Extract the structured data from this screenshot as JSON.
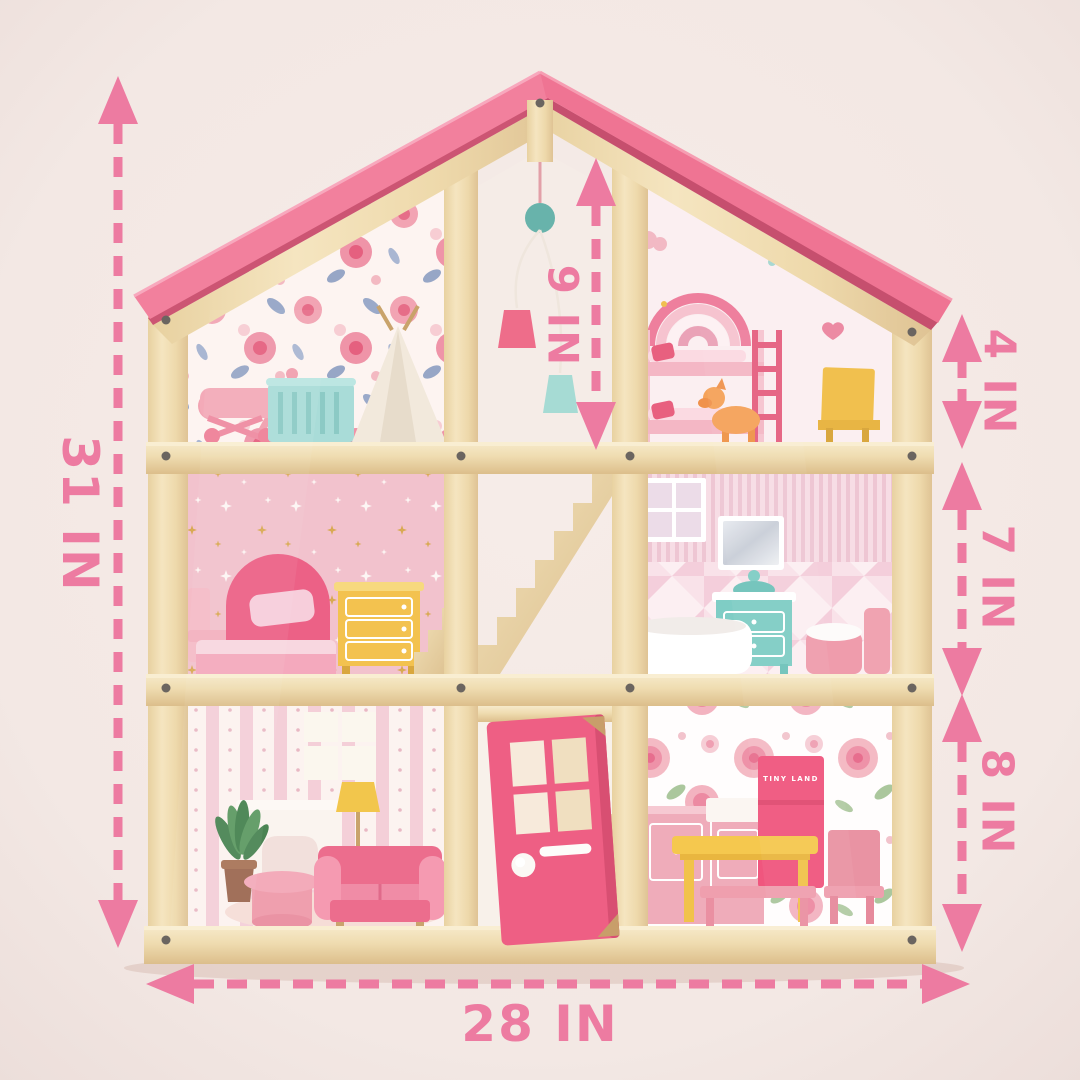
{
  "dimension_labels": {
    "overall_height": "31 IN",
    "overall_width": "28 IN",
    "stairwell": "9 IN",
    "attic_room": "4 IN",
    "middle_room": "7 IN",
    "ground_room": "8 IN"
  },
  "branding": {
    "fridge_logo": "TINY LAND"
  },
  "colors": {
    "background": "#f3e9e5",
    "dimension_pink": "#ed7ba1",
    "roof_pink": "#f2809d",
    "roof_shadow": "#cc5573",
    "wood_light": "#f2e0b6",
    "hot_pink": "#ee5f84",
    "teal": "#8fcfc7",
    "yellow": "#f5c84e",
    "mint": "#a9dcd8",
    "orange": "#f5a259"
  }
}
